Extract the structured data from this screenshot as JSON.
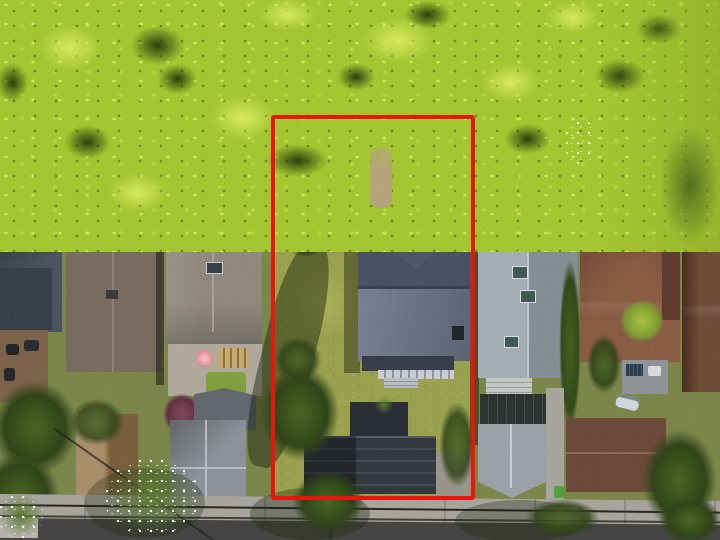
{
  "scene": {
    "type": "aerial-photograph",
    "description": "Overhead drone photo of a residential lot outlined by a red property-boundary rectangle; dense bright green tree canopy along the top, a row of neighbouring houses on both sides, the subject house with grey hip roof and a dark detached garage inside the outline, and a street with sidewalk and utility wires along the bottom edge.",
    "annotation": {
      "shape": "rectangle",
      "purpose": "property-boundary",
      "color": "#e8160c"
    },
    "objects": [
      "tree-canopy",
      "property-boundary-rectangle",
      "subject-house",
      "detached-garage",
      "front-lawn",
      "back-lawn",
      "gravel-path",
      "conifer-tree",
      "plum-tree",
      "white-blossom-trees",
      "neighbor-house-left-dark",
      "neighbor-house-left-long",
      "neighbor-house-left-gray",
      "neighbor-house-right-gray",
      "neighbor-house-right-brown",
      "neighbor-house-far-right",
      "pink-patio-umbrella",
      "backyard-deck",
      "white-car",
      "gray-gable-garage",
      "brown-garage",
      "green-bin",
      "sidewalk",
      "road",
      "utility-wires"
    ]
  },
  "palette": {
    "ground": "#7c864a",
    "canopy_base": "#a3c530",
    "canopy_light": "#d8e85e",
    "canopy_dark": "#2c400e",
    "canopy_olive": "#8ea32b",
    "forest_dark": "#55701e",
    "lawn": "#9aa14e",
    "lawn_light": "#aab05b",
    "subject_roof_upper": "#4a5162",
    "subject_roof_lower": "#6b7488",
    "subject_bay_dark": "#23272f",
    "porch_white": "#c9cdd2",
    "garage_roof": "#34383f",
    "conifer": "#31451a",
    "conifer_light": "#4a6524",
    "plum": "#5e3142",
    "blossom": "#ffffff",
    "umbrella_pink": "#e2909a",
    "house_a": "#4d545e",
    "house_b": "#776c5e",
    "house_c": "#8e887e",
    "house_d": "#9aa3ac",
    "house_e": "#8a5c44",
    "house_f": "#6f4b39",
    "tan_house": "#9b7d53",
    "gray_outbuilding": "#8d9298",
    "garage_gray": "#9ba1a7",
    "garage_brown": "#6b4a3a",
    "skylight_teal": "#3f5a52",
    "deck_brown": "#7c6349",
    "patio": "#b0a89b",
    "gravel": "#b2a284",
    "sidewalk": "#a7a49d",
    "road": "#454543",
    "wire": "#26261f",
    "bin_green": "#4fa13a",
    "car_white": "#cfd6da",
    "apron": "#99958b",
    "boundary_red": "#e8160c",
    "shadow": "rgba(22,30,10,0.45)"
  }
}
